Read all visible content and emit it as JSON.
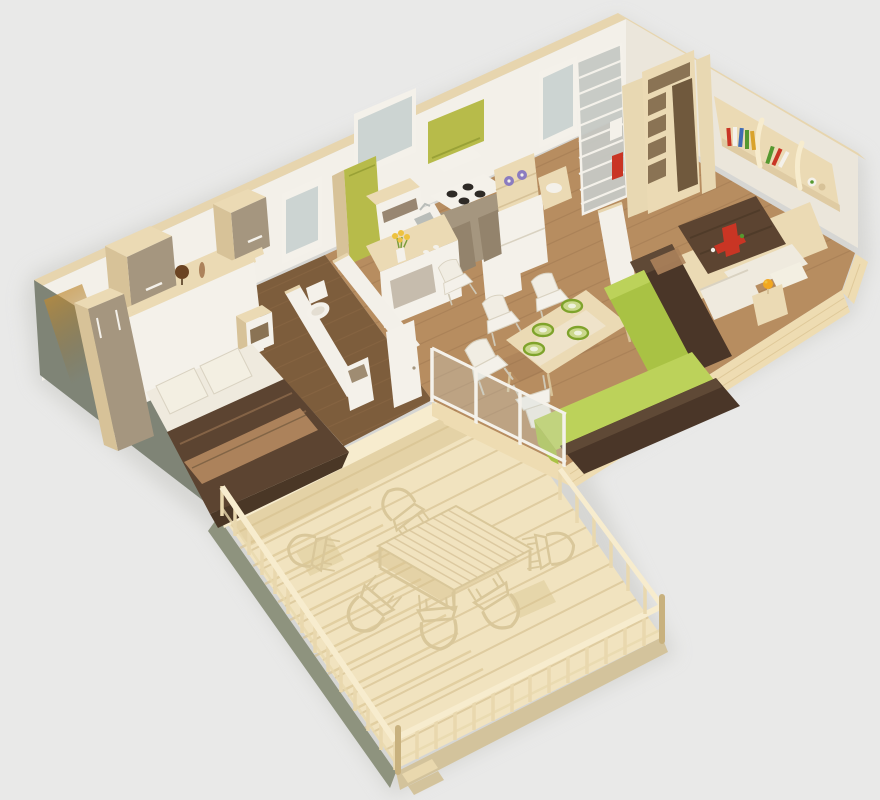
{
  "meta": {
    "title": "3D isometric floor plan render - two-bedroom cabin with wood deck",
    "canvas": {
      "width": 880,
      "height": 800
    },
    "view": "isometric cutaway, no roof"
  },
  "palette": {
    "bg": "#e9e9e8",
    "groundShadow": "#c7c7c3",
    "wallCap": "#e7d5ae",
    "wallFace": "#f3f0e9",
    "wallFaceShade": "#ebe6db",
    "leftWallDark": "#7f8476",
    "amberGlow": "#c08a30",
    "slabCream": "#eedcb2",
    "slabStripe": "#d9c18f",
    "floorOak": "#b78d60",
    "plankOak": "#96714b",
    "floorBed1": "#7d5d3c",
    "deckWood": "#f1e3bf",
    "deckPlank": "#ddc99c",
    "deckShadow": "#d8c28d",
    "deckFasciaL": "#8e937e",
    "deckFasciaR": "#d3c39c",
    "railWood": "#e9d8ae",
    "railCap": "#f7ecce",
    "railEdge": "#c8b17e",
    "outdoorFrame": "#d9c79a",
    "white": "#f4f1ea",
    "whiteShade": "#d9d2c1",
    "cream": "#ebdab4",
    "creamDark": "#d7c298",
    "taupe": "#a5967f",
    "taupeDeep": "#93836c",
    "slotDark": "#8a7354",
    "interiorDark": "#70593d",
    "kitchenGreen": "#b7bb4a",
    "kitchenGreenDeep": "#99a136",
    "burnerDark": "#2e2a26",
    "steelGray": "#b9bdb9",
    "sofaBrown": "#4a3628",
    "sofaBrownTop": "#5f4936",
    "sofaGreen": "#a9c244",
    "sofaGreenTop": "#bcd25a",
    "duvetBrown": "#5c4431",
    "duvetDeep": "#4a3726",
    "throwTan": "#ac825b",
    "pillowWhite": "#f3efe2",
    "mattressWhite": "#efeade",
    "plateRim": "#7fa32b",
    "plateFill": "#cbd88c",
    "plateCenter": "#eef2dc",
    "dishPurple": "#8b7cc0",
    "dishPurpleDark": "#6f5fa8",
    "flowerYellow": "#eec23e",
    "flowerStem": "#7a9c3a",
    "lampOrange": "#f2a71f",
    "toyRed": "#c93524",
    "bookBlue": "#3f6cb4",
    "bookGreen": "#55982f",
    "bookYellow": "#d9a32c",
    "glassBlue": "#cdd6d4",
    "doorGlassGray": "#c5c8c4",
    "doorCream": "#e8d8b2",
    "windowGlass": "#ccd4d2",
    "globeBrown": "#6b4423"
  },
  "scene": {
    "type": "3d-floorplan-render",
    "rooms": [
      {
        "id": "bedroom-master",
        "label": "Double bedroom",
        "items": [
          "double bed with brown duvet and tan throw",
          "two white pillows",
          "white headboard",
          "tall wardrobe",
          "two wall cabinets",
          "shelf with globe and vase",
          "nightstand"
        ]
      },
      {
        "id": "bathroom",
        "label": "Bathroom / WC",
        "items": [
          "toilet",
          "partition walls",
          "door ajar",
          "pedestal unit"
        ]
      },
      {
        "id": "kitchen",
        "label": "Kitchen",
        "items": [
          "green tall fridge cabinet",
          "green wall cabinet",
          "cooktop with 4 burners",
          "sink with faucet",
          "oven housing",
          "shelf unit with purple dishes",
          "white fridge",
          "island counter with yellow flowers"
        ]
      },
      {
        "id": "dining",
        "label": "Dining area",
        "items": [
          "cream dining table",
          "white chairs",
          "green place settings"
        ]
      },
      {
        "id": "living",
        "label": "Living area",
        "items": [
          "L-shaped sofa, dark brown frame with green cushions"
        ]
      },
      {
        "id": "bedroom-kids",
        "label": "Second bedroom",
        "items": [
          "bed with brown duvet",
          "red toy airplane",
          "pull-out white mattress",
          "nightstand with orange lamp",
          "wall bookshelf with colorful books and toys",
          "open wardrobe column"
        ]
      },
      {
        "id": "entry",
        "label": "Entry",
        "items": [
          "glazed slatted entrance door",
          "cream door ajar with red first-aid markings",
          "corridor door"
        ]
      },
      {
        "id": "deck",
        "label": "Wood deck / terrace",
        "items": [
          "pale wood decking",
          "baluster railing on two sides",
          "slatted outdoor table",
          "metal-frame outdoor chairs",
          "corner steps"
        ]
      }
    ],
    "counts": {
      "windows": 3,
      "burners": 4,
      "plates": 4,
      "indoor_chairs": 5,
      "outdoor_chairs": 6,
      "deck_rail_segments": 3
    }
  }
}
